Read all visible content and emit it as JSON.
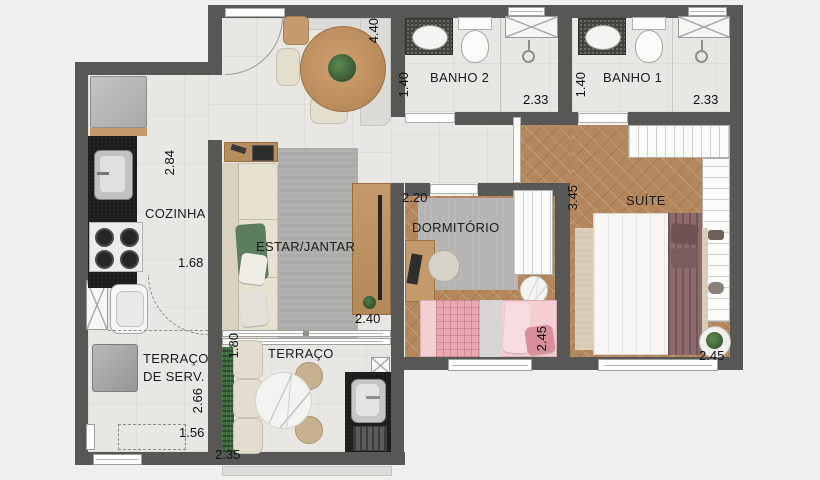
{
  "rooms": {
    "cozinha": "COZINHA",
    "estar_jantar": "ESTAR/JANTAR",
    "dormitorio": "DORMITÓRIO",
    "suite": "SUÍTE",
    "banho1": "BANHO 1",
    "banho2": "BANHO 2",
    "terraco": "TERRAÇO",
    "terraco_serv_line1": "TERRAÇO",
    "terraco_serv_line2": "DE SERV."
  },
  "dimensions": {
    "estar_length": "4.40",
    "estar_width": "2.40",
    "banho2_width": "1.40",
    "banho2_length": "2.33",
    "banho1_width": "1.40",
    "banho1_length": "2.33",
    "cozinha_length": "2.84",
    "cozinha_width": "1.68",
    "dormitorio_width": "2.20",
    "dormitorio_length": "2.45",
    "suite_length": "3.45",
    "suite_width": "2.45",
    "terraco_serv_length": "2.66",
    "terraco_serv_width": "1.56",
    "terraco_length": "1.80",
    "terraco_width": "2.35"
  },
  "colors": {
    "background": "#efefee",
    "wall": "#575756",
    "tile_floor": "#e9e7e3",
    "wood_floor": "#b5875c",
    "label_text": "#1b1b1b",
    "counter_black": "#1d1d1d",
    "sofa_beige": "#e7e1d1",
    "rug_gray": "#acacaa",
    "bed_pink": "#f3cfd3",
    "bed_white": "#f7f6f4",
    "accent_mauve": "#8d6a6d",
    "plant_green": "#4e7a4a",
    "suite_rug_beige": "#d8cbb6"
  }
}
